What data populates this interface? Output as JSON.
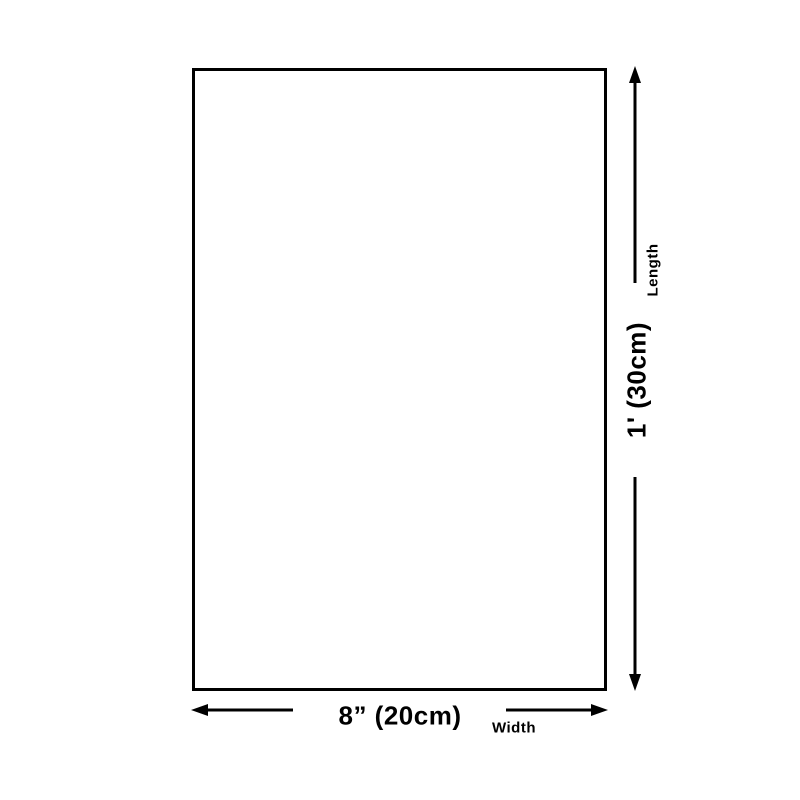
{
  "diagram": {
    "title": "product-dimension-diagram",
    "length_value": "1' (30cm)",
    "length_label": "Length",
    "width_value": "8” (20cm)",
    "width_label": "Width"
  },
  "colors": {
    "ink": "#000000",
    "bg": "#ffffff"
  }
}
